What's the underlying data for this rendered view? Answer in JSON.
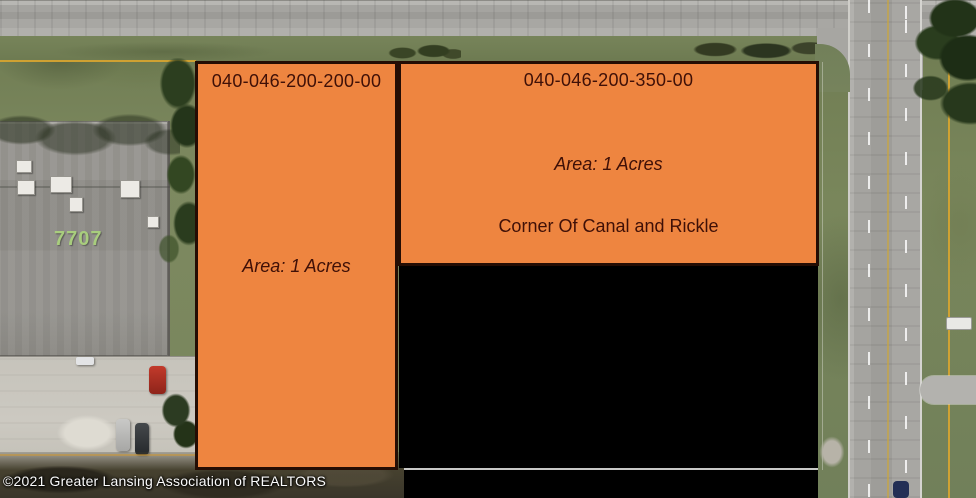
{
  "canvas": {
    "width": 976,
    "height": 498,
    "description": "Aerial satellite view with real-estate parcel overlays at the corner of Canal and Rickle"
  },
  "parcels": [
    {
      "id": "040-046-200-200-00",
      "area_label": "Area: 1 Acres"
    },
    {
      "id": "040-046-200-350-00",
      "area_label": "Area: 1 Acres",
      "location_label": "Corner Of Canal and Rickle"
    }
  ],
  "building": {
    "number": "7707"
  },
  "watermark": {
    "copyright": "©2021 Greater Lansing Association of REALTORS"
  },
  "colors": {
    "parcel_fill": "#EE8540",
    "parcel_border": "#240D04",
    "parcel_text": "#3F1007",
    "blocked_fill": "#000000",
    "boundary_line": "#D9A52F",
    "divider_line": "#C9C9C7"
  }
}
